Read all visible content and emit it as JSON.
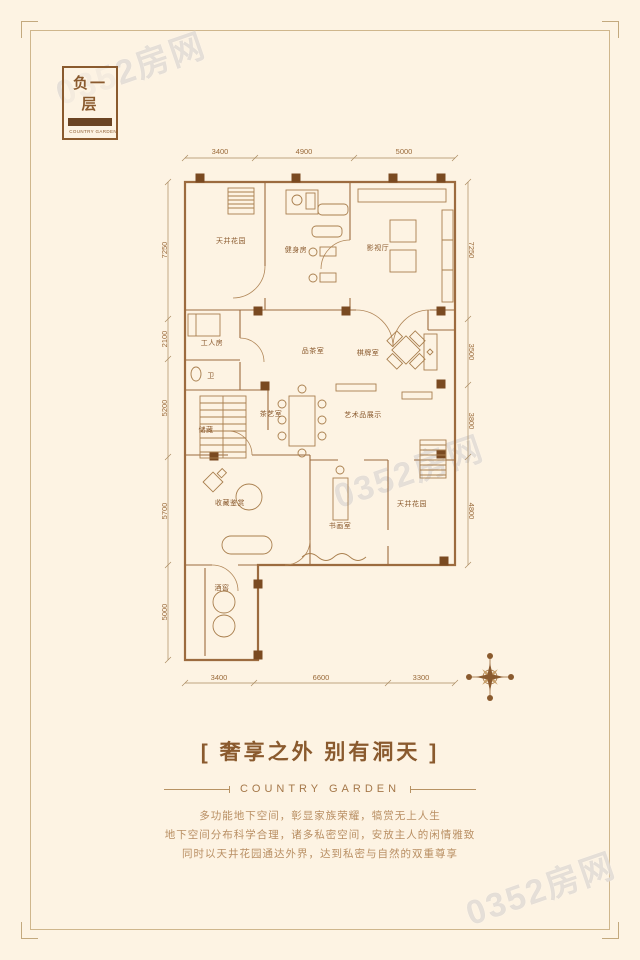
{
  "badge": {
    "floor": "负一层",
    "brand": "COUNTRY GARDEN"
  },
  "plan": {
    "rooms": [
      "天井花园",
      "健身房",
      "影视厅",
      "工人房",
      "卫",
      "品茶室",
      "棋牌室",
      "储藏",
      "茶艺室",
      "艺术品展示",
      "收藏鉴赏",
      "书画室",
      "天井花园",
      "酒窖"
    ],
    "dims": {
      "top": [
        "3400",
        "4900",
        "5000"
      ],
      "bottom": [
        "3400",
        "6600",
        "3300"
      ],
      "left": [
        "7250",
        "2100",
        "5200",
        "5700",
        "5000"
      ],
      "right": [
        "7250",
        "3500",
        "3800",
        "4800"
      ]
    }
  },
  "footer": {
    "title": "[ 奢享之外 别有洞天 ]",
    "brand": "COUNTRY GARDEN",
    "description": [
      "多功能地下空间，彰显家族荣耀，犒赏无上人生",
      "地下空间分布科学合理，诸多私密空间，安放主人的闲情雅致",
      "同时以天井花园通达外界，达到私密与自然的双重尊享"
    ]
  },
  "watermark": {
    "text": "0352房网"
  },
  "colors": {
    "bg": "#fdf3e3",
    "line": "#9c6b3f",
    "accent": "#8a5a2e",
    "column": "#7a4a21"
  }
}
